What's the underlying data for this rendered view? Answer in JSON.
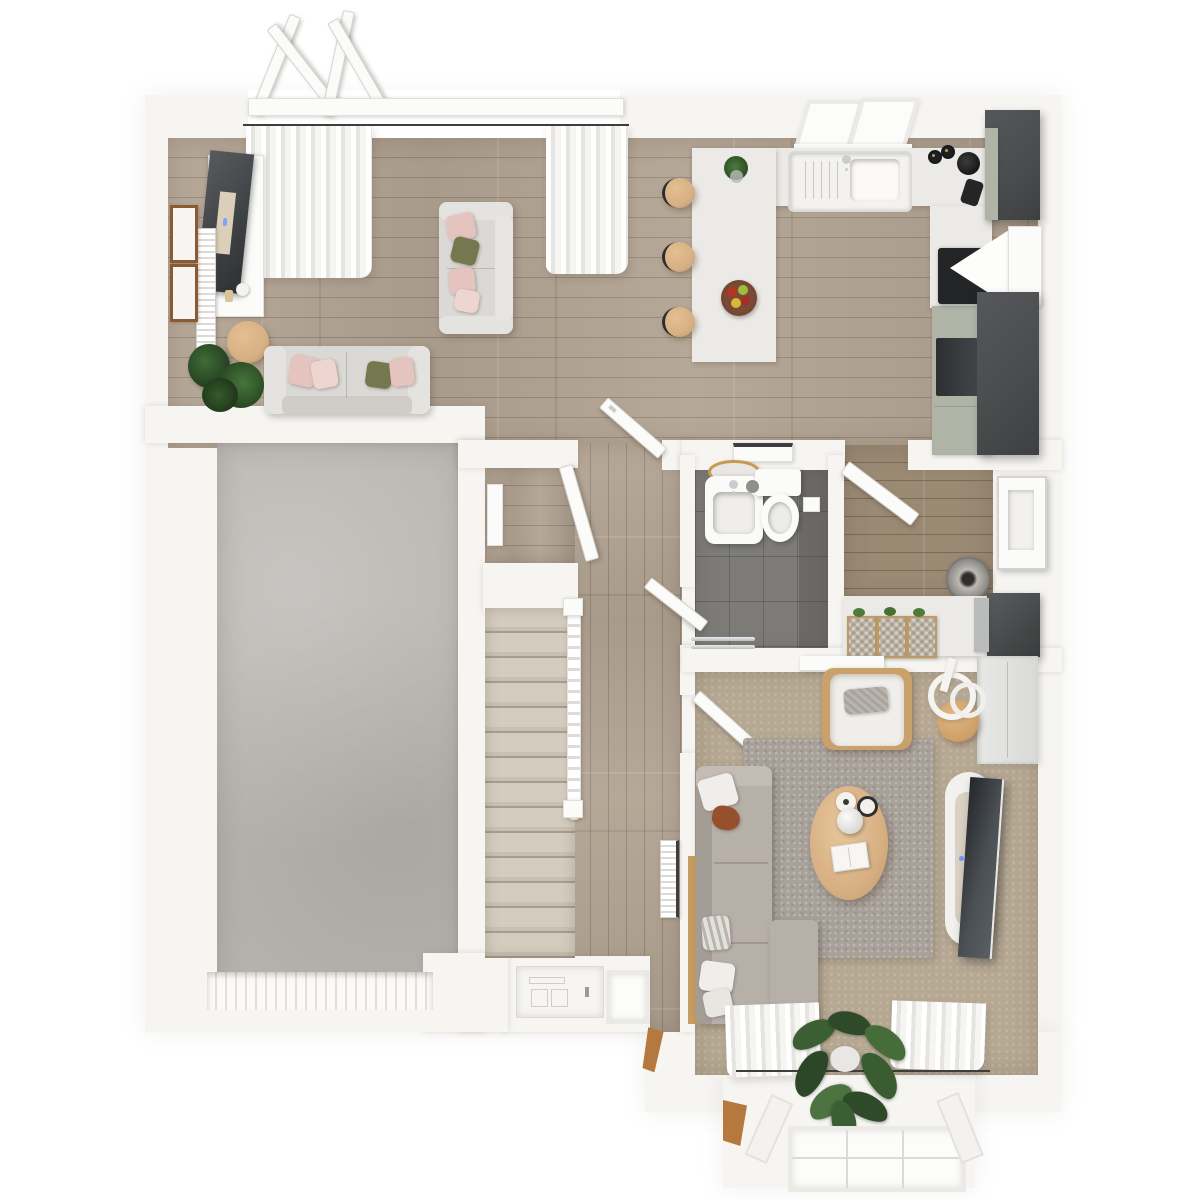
{
  "scene": {
    "type": "3d-floor-plan-top-down-render",
    "floor": "ground-floor",
    "visible_text": "none"
  },
  "colors": {
    "outside": "#ffffff",
    "wall": "#f6f5f2",
    "wood": "#b2a392",
    "wood_dark": "#9a8a74",
    "concrete": "#b7b4af",
    "tile": "#7d7c79",
    "carpet": "#b6a893",
    "rug": "#a8a19a",
    "stair_shadow": "#a59d8f",
    "counter": "#ebeae6",
    "cabinet_dark": "#4a4c4e",
    "cabinet_sage": "#afb4a7",
    "appliance_black": "#222426",
    "sofa_light": "#dbd9d5",
    "sofa_taupe": "#b7b0a9",
    "cushion_white": "#f0eeea",
    "pillow_pink": "#e5c3bf",
    "pillow_olive": "#75784f",
    "pillow_rust": "#97502e",
    "wood_furniture": "#d7b084",
    "plant_green": "#32512b",
    "frame_brown": "#8a5a33",
    "chrome": "#c9cdcf",
    "brass": "#c49a4e",
    "door_white": "#fbfbf9",
    "glass": "#fcfcfa",
    "rod_dark": "#3f3e3c"
  },
  "rooms": [
    {
      "name": "open-plan-lounge",
      "floor_material": "wood"
    },
    {
      "name": "kitchen-dining",
      "floor_material": "wood"
    },
    {
      "name": "garage",
      "floor_material": "concrete"
    },
    {
      "name": "hallway",
      "floor_material": "wood"
    },
    {
      "name": "under-stair-closet",
      "floor_material": "wood"
    },
    {
      "name": "bathroom",
      "floor_material": "gray-tile"
    },
    {
      "name": "utility-room",
      "floor_material": "wood"
    },
    {
      "name": "living-room",
      "floor_material": "beige-carpet"
    },
    {
      "name": "entrance-porch",
      "floor_material": "white"
    },
    {
      "name": "bay-window",
      "floor_material": "none"
    }
  ],
  "furniture": {
    "lounge": [
      "tv-cabinet",
      "leaning-tv",
      "radiator",
      "picture-frame",
      "picture-frame",
      "round-pouf",
      "potted-plant",
      "two-seat-sofa",
      "two-seat-sofa-vertical",
      "throw-pillows",
      "curtains",
      "french-doors"
    ],
    "kitchen": [
      "u-shaped-counter",
      "breakfast-peninsula",
      "bar-stool",
      "bar-stool",
      "bar-stool",
      "double-sink",
      "faucet",
      "fruit-bowl",
      "plant-vase",
      "kettle",
      "espresso-maker",
      "salt-pepper",
      "induction-hob",
      "extractor-hood",
      "oven",
      "tall-fridge-unit",
      "tall-pantry-unit",
      "skylight-window"
    ],
    "hallway": [
      "staircase",
      "banister",
      "radiator",
      "closet-shelf",
      "front-door",
      "sidelight-window",
      "interior-doors"
    ],
    "bathroom": [
      "wall-sink",
      "oval-mirror",
      "toilet",
      "toilet-brush",
      "paper-holder",
      "towel-rail",
      "shelf"
    ],
    "utility": [
      "laundry-basket",
      "counter",
      "wicker-basket",
      "wicker-basket",
      "wicker-basket",
      "washing-machine",
      "back-door"
    ],
    "living_room": [
      "sectional-sofa",
      "chaise",
      "throw-pillows",
      "oval-coffee-table",
      "vases",
      "book",
      "armchair",
      "lumbar-pillow",
      "side-table",
      "arc-floor-lamp",
      "tv-console",
      "wall-tv",
      "storage-cupboard",
      "wall-shelf",
      "area-rug",
      "monstera-plant",
      "curtains",
      "bay-window"
    ],
    "garage": [
      "sectional-garage-door"
    ]
  }
}
